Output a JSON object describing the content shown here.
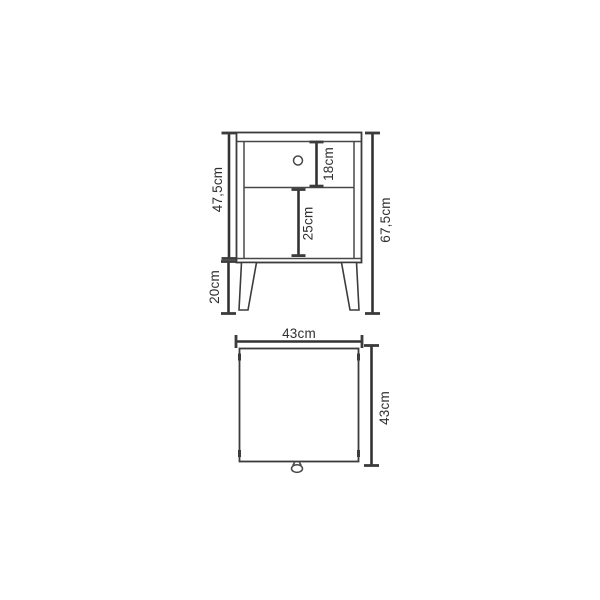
{
  "colors": {
    "background": "#ffffff",
    "line": "#3c3c3c",
    "dimension_line": "#333333",
    "text": "#2f2f2f"
  },
  "front_view": {
    "labels": {
      "carcass_height": "47,5cm",
      "leg_height": "20cm",
      "overall_height": "67,5cm",
      "drawer_height": "18cm",
      "compartment_height": "25cm"
    }
  },
  "top_view": {
    "labels": {
      "width": "43cm",
      "depth": "43cm"
    }
  }
}
